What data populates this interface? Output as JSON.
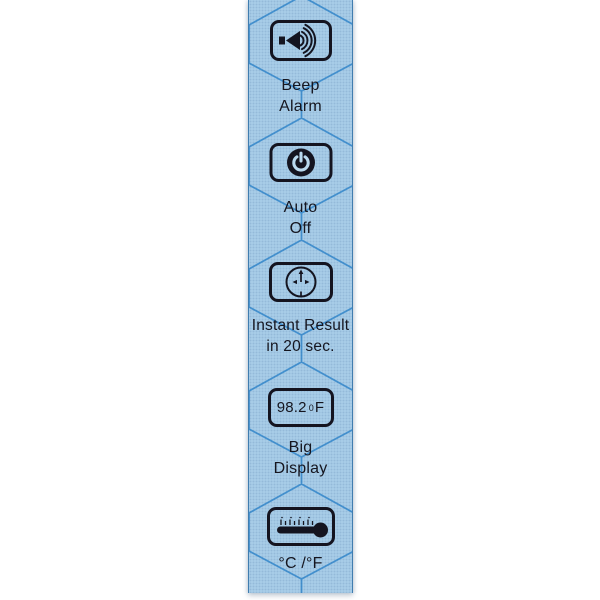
{
  "page": {
    "background_color": "#FFFFFF"
  },
  "strip": {
    "background_color": "#ABD0EA",
    "pattern_line_color": "#3E8FD0",
    "ink_color": "#15151F",
    "sections": [
      {
        "icon": "speaker-sound-waves-icon",
        "lines": [
          "Beep",
          "Alarm"
        ]
      },
      {
        "icon": "power-icon",
        "lines": [
          "Auto",
          "Off"
        ]
      },
      {
        "icon": "clock-timer-icon",
        "lines": [
          "Instant Result",
          "in 20 sec."
        ]
      },
      {
        "icon": "temperature-display",
        "display": {
          "number": "98.2",
          "degree": "0",
          "unit": "F"
        },
        "lines": [
          "Big",
          "Display"
        ]
      },
      {
        "icon": "thermometer-icon",
        "lines": [
          "°C /°F"
        ]
      }
    ]
  }
}
